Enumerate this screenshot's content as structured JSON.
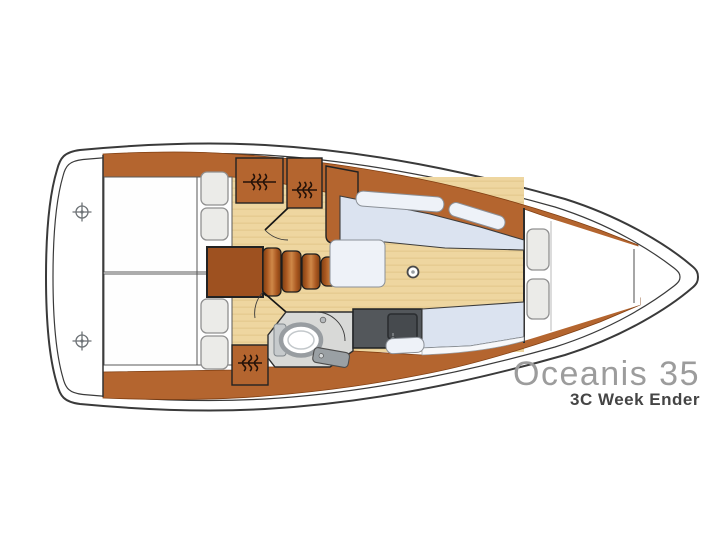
{
  "branding": {
    "model": "Oceanis 35",
    "layout_code": "3C Week Ender"
  },
  "colors": {
    "outline": "#3a3a3a",
    "line": "#222222",
    "wood": "#b4652f",
    "wood_dark": "#813f12",
    "wood_deep": "#9e5120",
    "wood_light": "#cf8848",
    "floor": "#eed6a0",
    "grain": "#d9b97c",
    "settee": "#dbe3f0",
    "settee_light": "#eef2f8",
    "cushion_edge": "#8b9097",
    "counter": "#53575b",
    "sink": "#464a4e",
    "bath": "#d8d9d7",
    "fixture": "#9aa0a4",
    "pillow": "#ebebe8",
    "pillow_edge": "#909090",
    "title": "#9c9c9c",
    "subtitle": "#454545"
  },
  "icons": {
    "cleat-icon": "circled cross ⊕",
    "hanging-locker-icon": "rail with hanger squiggles",
    "mast-post-icon": "small ringed circle",
    "shower-icon": "quarter-circle arc",
    "toilet-icon": "oval bowl with tank",
    "sink-icon": "rounded basin with faucet"
  }
}
